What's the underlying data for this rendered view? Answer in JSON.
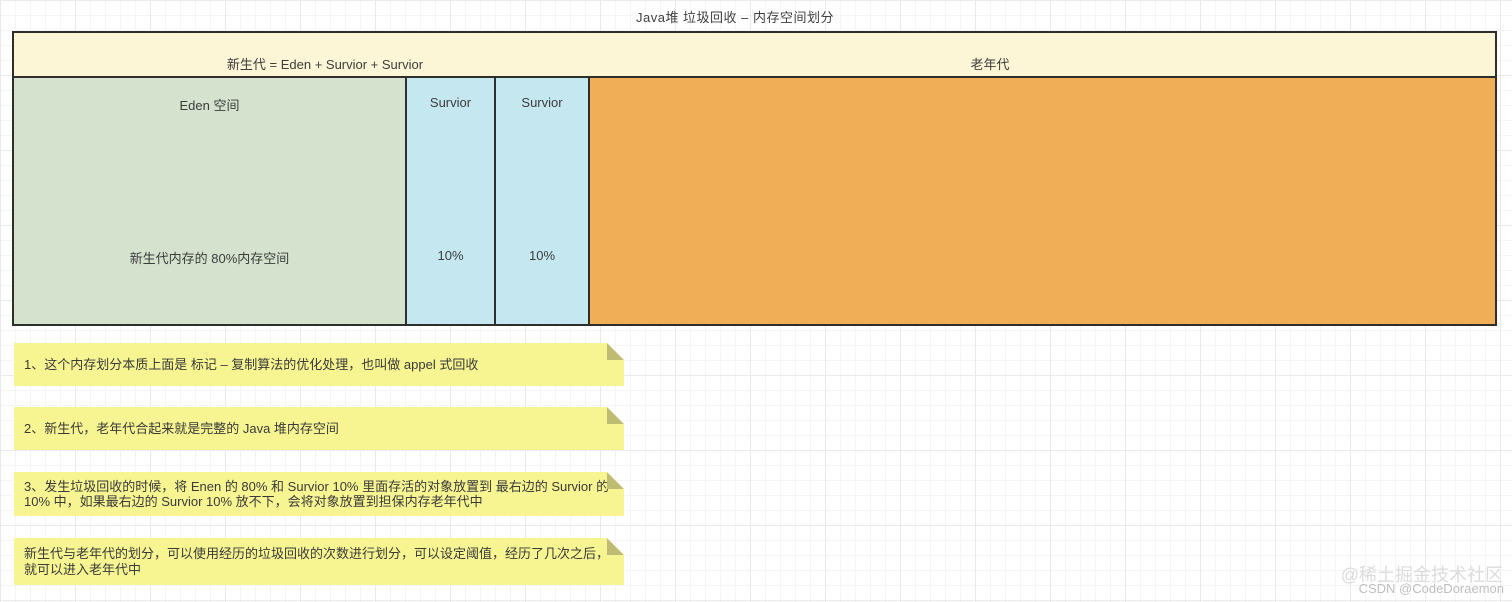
{
  "title": "Java堆 垃圾回收 – 内存空间划分",
  "diagram": {
    "header": {
      "young_label": "新生代 = Eden + Survior + Survior",
      "old_label": "老年代"
    },
    "regions": [
      {
        "id": "eden",
        "label": "Eden 空间",
        "sublabel": "新生代内存的 80%内存空间"
      },
      {
        "id": "survivor-1",
        "label": "Survior",
        "sublabel": "10%"
      },
      {
        "id": "survivor-2",
        "label": "Survior",
        "sublabel": "10%"
      },
      {
        "id": "old-gen"
      }
    ]
  },
  "notes": [
    {
      "text": "1、这个内存划分本质上面是 标记 – 复制算法的优化处理，也叫做 appel 式回收"
    },
    {
      "text": "2、新生代，老年代合起来就是完整的 Java 堆内存空间"
    },
    {
      "text": "3、发生垃圾回收的时候，将 Enen 的 80% 和 Survior 10% 里面存活的对象放置到 最右边的 Survior 的 10% 中，如果最右边的 Survior 10% 放不下，会将对象放置到担保内存老年代中"
    },
    {
      "text": "新生代与老年代的划分，可以使用经历的垃圾回收的次数进行划分，可以设定阈值，经历了几次之后，就可以进入老年代中"
    }
  ],
  "watermarks": {
    "juejin": "@稀土掘金技术社区",
    "csdn": "CSDN @CodeDoraemon"
  },
  "colors": {
    "header_fill": "#FCF5D6",
    "eden_fill": "#D4E2CE",
    "survivor_fill": "#C5E7F0",
    "old_gen_fill": "#F0AE57",
    "note_fill": "#F7F592",
    "note_fold": "#BDBC72",
    "shape_border": "#2E2E2B",
    "text": "#3C3C3C",
    "watermark_juejin": "#DCDCDC",
    "watermark_csdn": "#BFBFBF"
  }
}
